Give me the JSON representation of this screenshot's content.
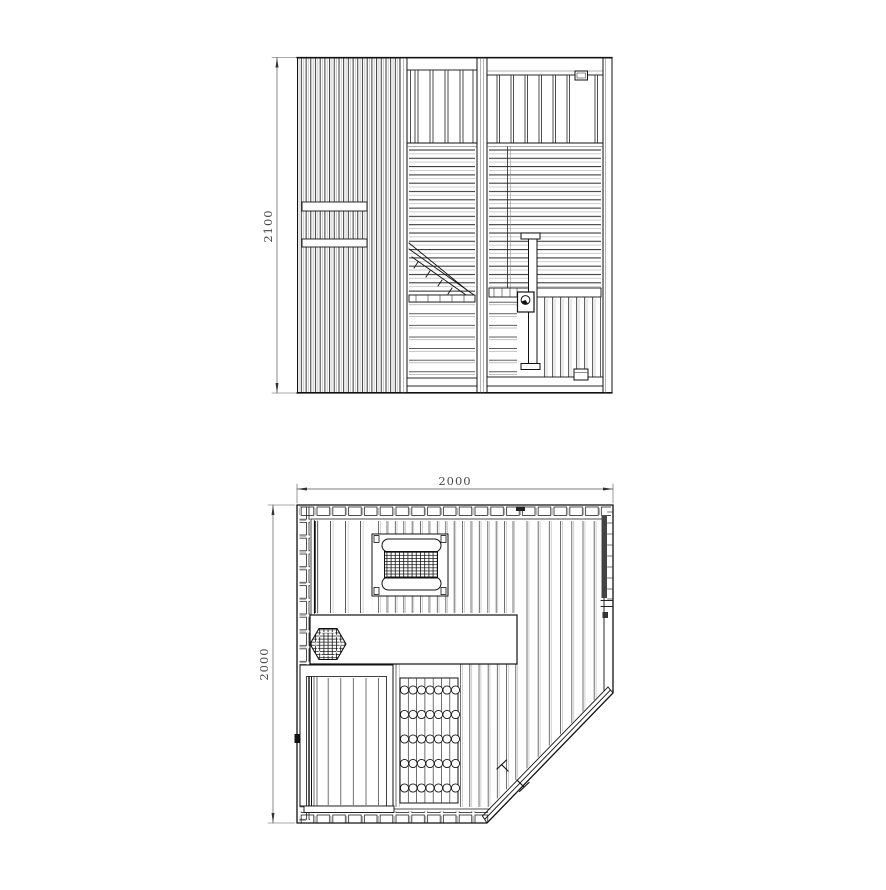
{
  "colors": {
    "background": "#ffffff",
    "line": "#1f1f1f",
    "secondary_line": "#999999",
    "dimension_text": "#4a4a4a"
  },
  "dimensions": {
    "elevation_height": "2100",
    "plan_width": "2000",
    "plan_depth": "2000"
  }
}
